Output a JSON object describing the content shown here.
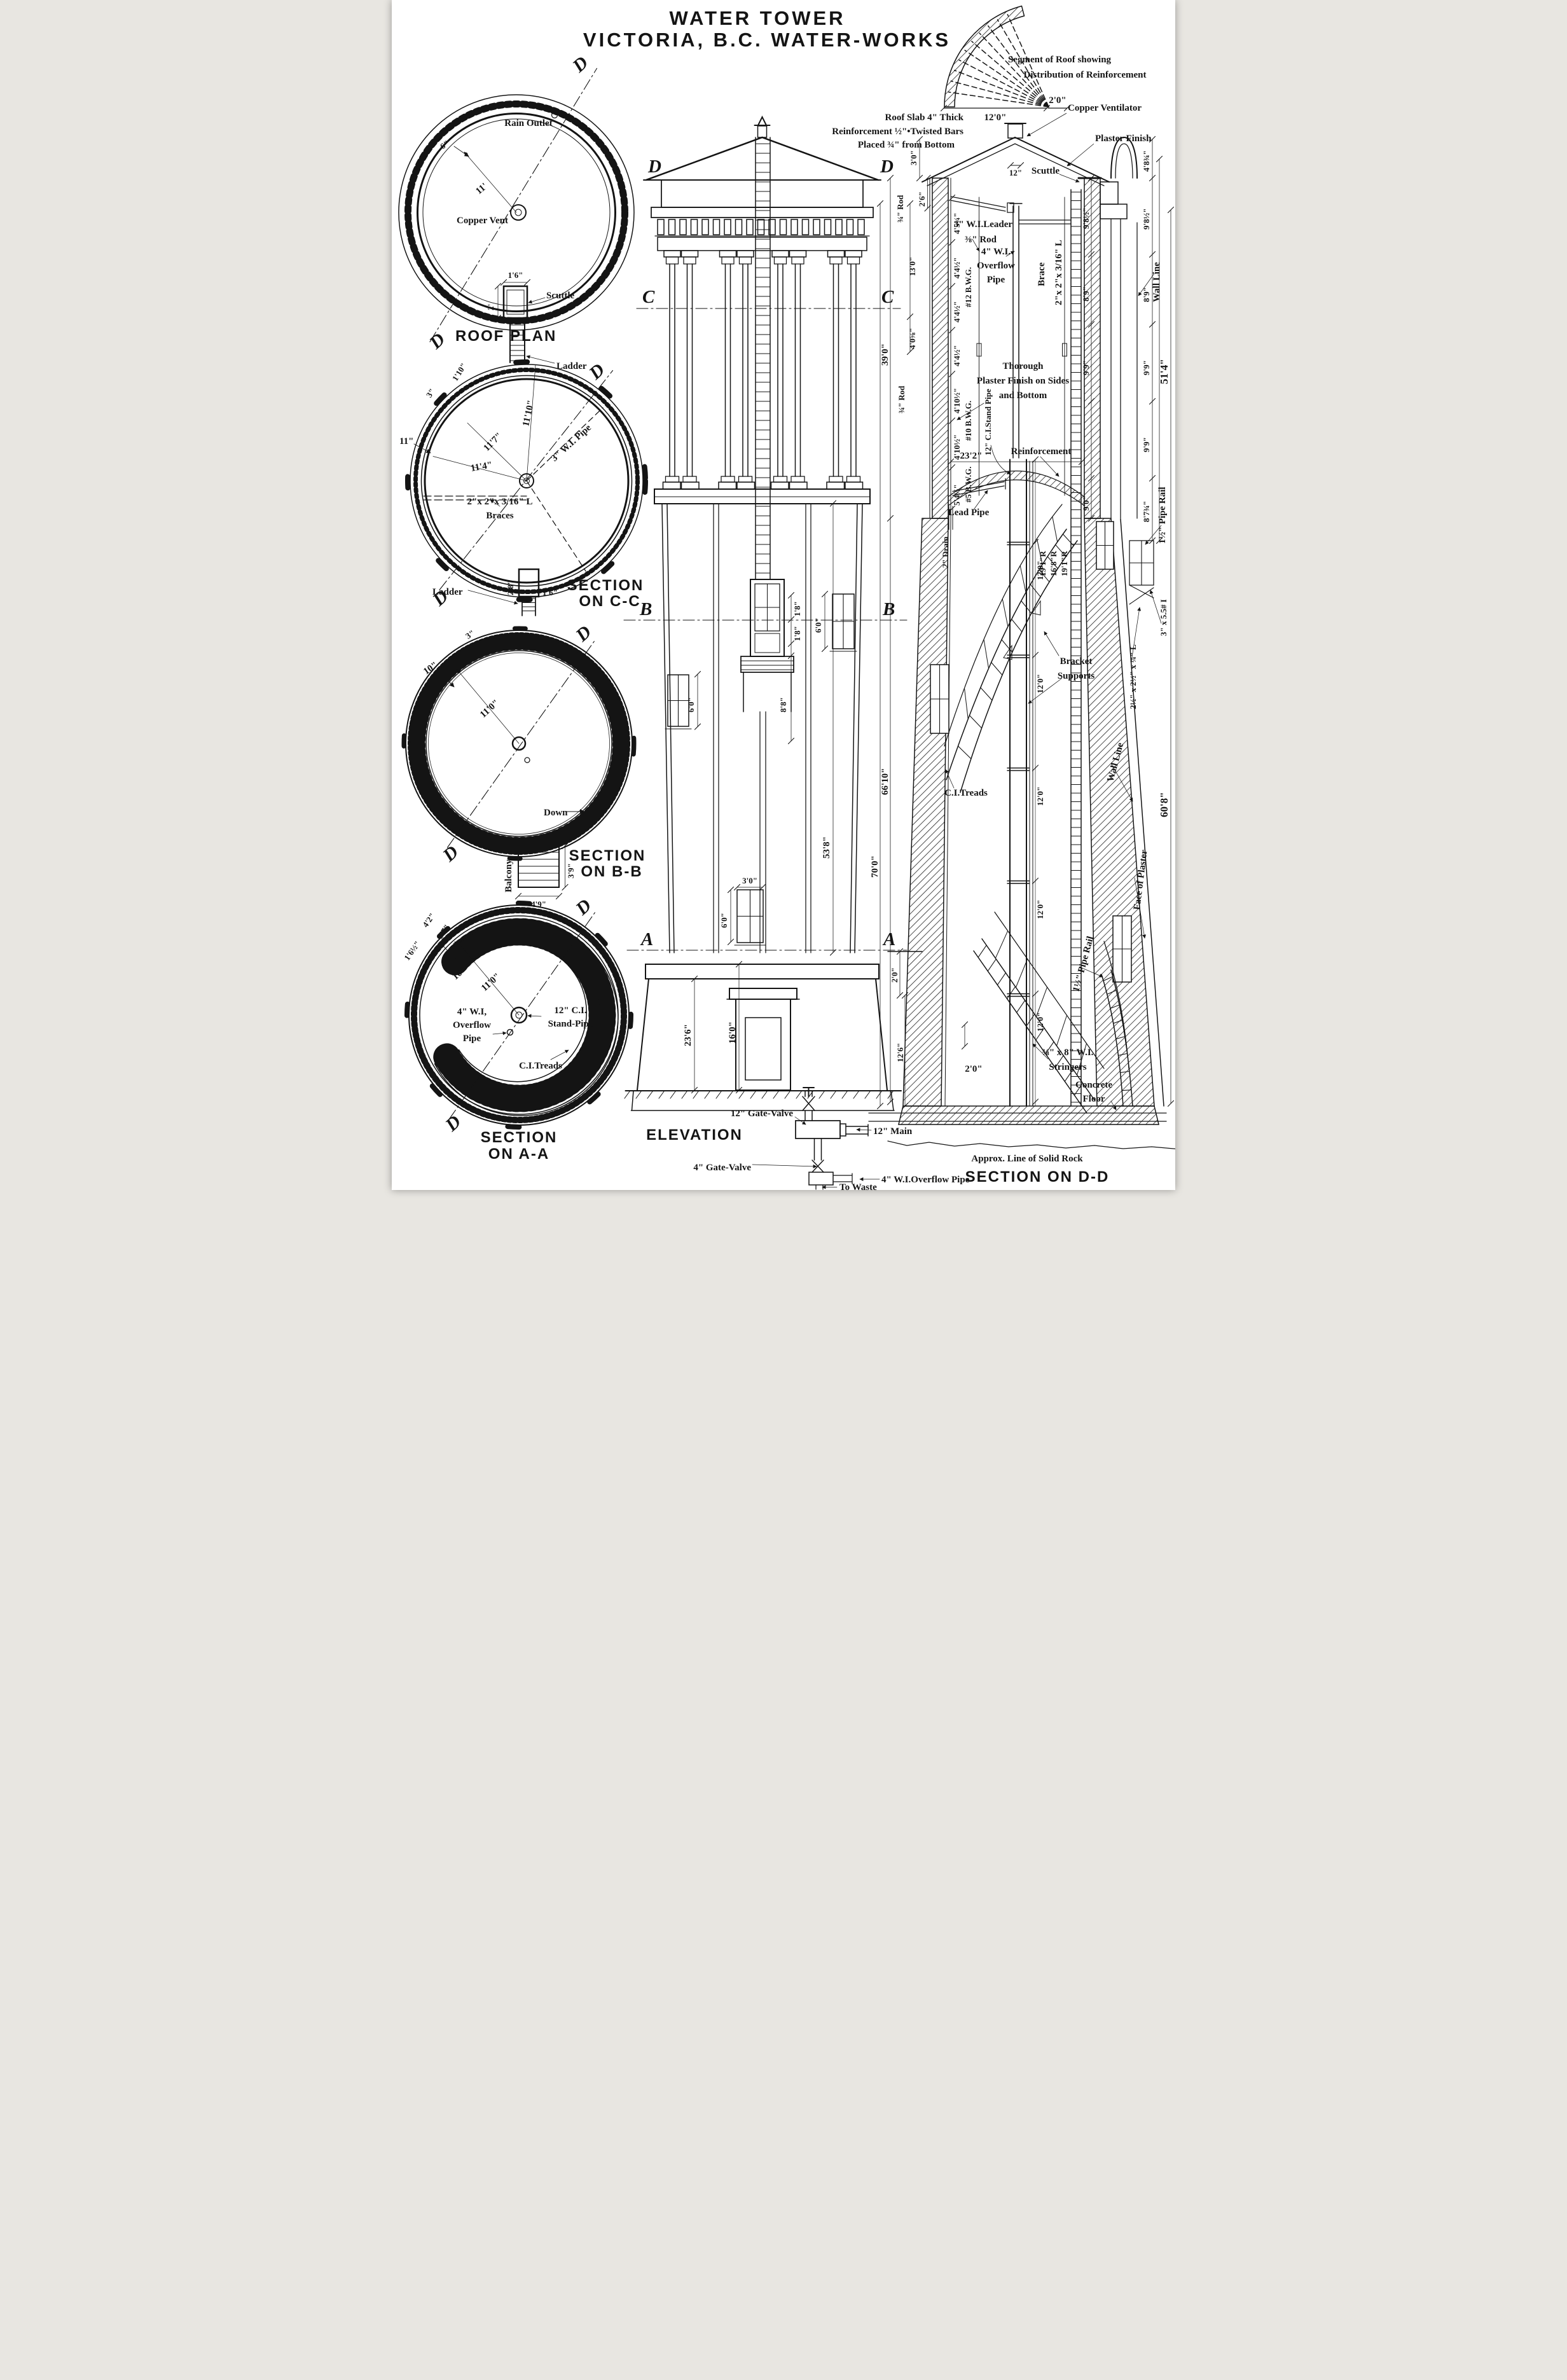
{
  "title": {
    "line1": "WATER TOWER",
    "line2": "VICTORIA, B.C. WATER-WORKS"
  },
  "roof_segment": {
    "caption1": "Segment of Roof showing",
    "caption2": "Distribution of Reinforcement",
    "dim_span": "12'0\"",
    "dim_overhang": "2'0\""
  },
  "roof_notes": {
    "l1": "Roof Slab 4\" Thick",
    "l2": "Reinforcement ½\"•Twisted Bars",
    "l3": "Placed ¾\" from Bottom"
  },
  "roof_plan": {
    "caption": "ROOF PLAN",
    "rain_outlet": "Rain Outlet",
    "copper_vent": "Copper Vent",
    "scuttle": "Scuttle",
    "ladder": "Ladder",
    "dim_radius": "11'",
    "dim_curb": "6\"",
    "dim_scuttle_w": "1'6\"",
    "dim_scuttle_h": "2'",
    "d1": "D",
    "d2": "D"
  },
  "section_cc": {
    "cap1": "SECTION",
    "cap2": "ON C-C",
    "dim1": "1'10\"",
    "dim2": "3\"",
    "dim_wall": "11\"",
    "r1": "11'10\"",
    "r2": "11'7\"",
    "r3": "11'4\"",
    "pipe": "3\" W.I. Pipe",
    "brace_size": "2\"x 2\"x 3/16\" L",
    "braces": "Braces",
    "ladder": "Ladder",
    "dim_sc_h": "2'8\"",
    "dim_sc_w": "1'6\"",
    "d1": "D",
    "d2": "D"
  },
  "section_bb": {
    "cap1": "SECTION",
    "cap2": "ON B-B",
    "dim_curb": "3\"",
    "dim_wall": "10\"",
    "radius": "11'0\"",
    "down": "Down",
    "balcony": "Balcony",
    "dim_h": "3'9\"",
    "dim_w": "4'9\"",
    "d1": "D",
    "d2": "D"
  },
  "section_aa": {
    "cap1": "SECTION",
    "cap2": "ON A-A",
    "dim1": "4'2\"",
    "dim2": "8'7\"",
    "dim3": "3\"",
    "dim4": "1'6½\"",
    "dim_wall": "10\"",
    "radius": "11'0\"",
    "ov1": "4\" W.I,",
    "ov2": "Overflow",
    "ov3": "Pipe",
    "sp1": "12\" C.I.",
    "sp2": "Stand-Pipe",
    "treads": "C.I.Treads",
    "up": "Up",
    "d1": "D",
    "d2": "D"
  },
  "elevation": {
    "caption": "ELEVATION",
    "d1": "D",
    "d2": "D",
    "c1": "C",
    "c2": "C",
    "b1": "B",
    "b2": "B",
    "a1": "A",
    "a2": "A",
    "w18a": "1'8\"",
    "w18b": "1'8\"",
    "w88": "8'8\"",
    "w60l": "6'0\"",
    "w60r": "6'0\"",
    "w60c": "6'0\"",
    "w30": "3'0\"",
    "shaft": "53'8\"",
    "base_h": "16'0\"",
    "base_t": "23'6\"",
    "gate12": "12\" Gate-Valve",
    "gate4": "4\" Gate-Valve",
    "main12": "12\" Main",
    "ovf4": "4\" W.I.Overflow Pipe",
    "waste": "To Waste"
  },
  "section_dd": {
    "caption": "SECTION ON D-D",
    "rock": "Approx. Line of Solid Rock",
    "scuttle": "Scuttle",
    "vent": "Copper Ventilator",
    "plaster": "Plaster Finish",
    "dim_vent": "12\"",
    "dim_rise": "3'0\"",
    "dim_free": "2'6\"",
    "leader": "3\" W.I.Leader",
    "rod38": "⅜\" Rod",
    "rod34a": "¾\" Rod",
    "rod34b": "¾\" Rod",
    "dim_rod": "13'0\"",
    "dim_depth": "39'0\"",
    "dim_curb": "4'0⅝\"",
    "ov1": "4\" W.I.",
    "ov2": "Overflow",
    "ov3": "Pipe",
    "brace": "Brace",
    "brace_size": "2\"x 2\"x 3/16\" L",
    "pl1": "Thorough",
    "pl2": "Plaster Finish on Sides",
    "pl3": "and Bottom",
    "standpipe": "12\" C.I.Stand Pipe",
    "g1": "4'5¼\"",
    "g2": "4'4½\"",
    "g3": "4'4½\"",
    "g4": "4'4½\"",
    "g5": "4'10½\"",
    "g6": "4'10½\"",
    "g7": "5'4½\"",
    "bwg12": "#12 B.W.G.",
    "bwg10": "#10 B.W.G.",
    "bwg5": "#5 B.W.G.",
    "dim_span": "23'2\"",
    "reinf": "Reinforcement",
    "lead": "Lead Pipe",
    "drain": "2\" Drain",
    "r1": "19'1\"R",
    "r2": "16'8\"R",
    "r3": "19'1\"R",
    "sp_dims": [
      "12'0\"",
      "12'0\"",
      "12'0\"",
      "12'0\"",
      "12'0\""
    ],
    "br1": "Bracket",
    "br2": "Supports",
    "treads": "C.I.Treads",
    "wall_line1": "Wall Line",
    "wall_line2": "Wall Line",
    "face": "Face of Plaster",
    "rail1": "1½\" Pipe Rail",
    "rail2": "1½\" Pipe Rail",
    "ibeam": "3\" x 5.5# I",
    "angle": "2½\" x 2½\" x ¼\" L",
    "str1": "⅜\" x 8\" W.I.",
    "str2": "Stringers",
    "conc1": "Concrete",
    "conc2": "Floor",
    "ci": [
      "9'8½\"",
      "8'9\"",
      "9'9\"",
      "9'0\""
    ],
    "co": [
      "4'8¾\"",
      "9'8½\"",
      "8'9\"",
      "9'9\"",
      "9'9\"",
      "8'7¾\""
    ],
    "total_wall": "51'4\"",
    "total_right": "60'8\"",
    "grade": "2'0\"",
    "basement": "12'6\"",
    "floor_dim": "2'0\""
  }
}
